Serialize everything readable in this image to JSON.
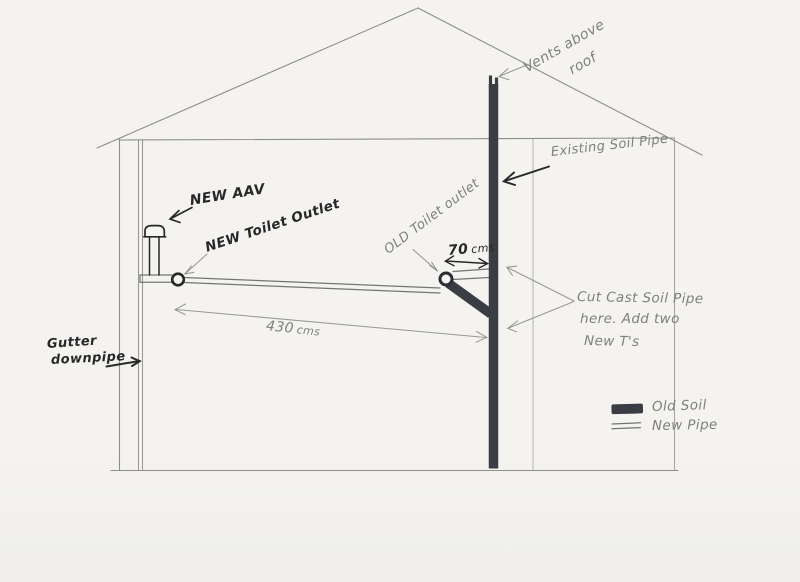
{
  "colors": {
    "paper": "#f4f3ef",
    "pencil": "#8e8e8a",
    "pencil-text": "#7f807b",
    "ink": "#28282b",
    "pipe": "#3a3d44"
  },
  "annotations": {
    "vents_line1": "Vents above",
    "vents_line2": "roof",
    "existing_soil_pipe": "Existing Soil Pipe",
    "new_aav": "NEW AAV",
    "new_toilet_outlet": "NEW Toilet Outlet",
    "old_toilet_outlet": "OLD Toilet outlet",
    "gutter_line1": "Gutter",
    "gutter_line2": "downpipe",
    "cut_note_line1": "Cut Cast Soil Pipe",
    "cut_note_line2": "here. Add two",
    "cut_note_line3": "New T's"
  },
  "dimensions": {
    "branch": {
      "value": "70",
      "unit": "cms"
    },
    "run": {
      "value": "430",
      "unit": "cms"
    }
  },
  "legend": {
    "old_soil": "Old Soil",
    "new_pipe": "New Pipe"
  }
}
